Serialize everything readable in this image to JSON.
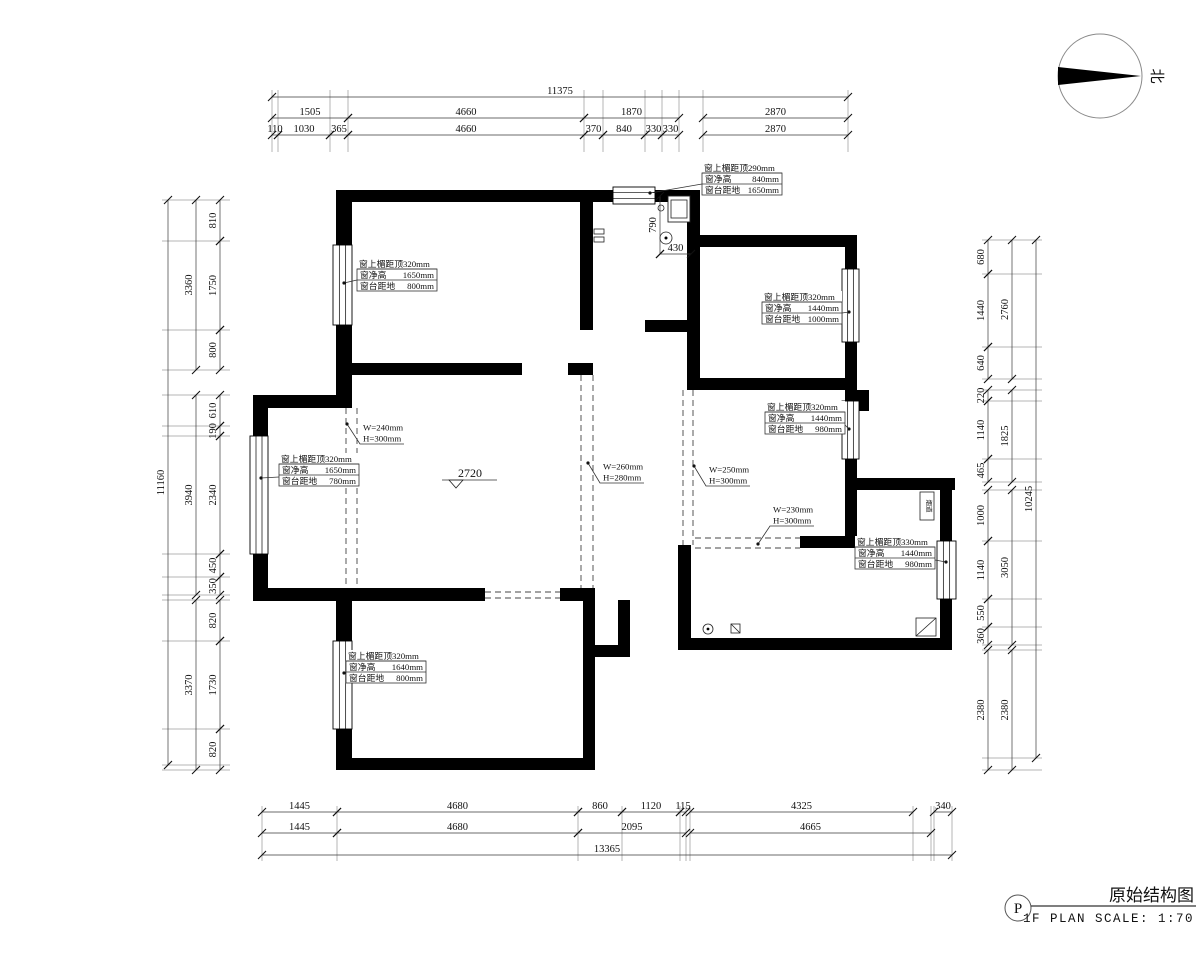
{
  "title_block": {
    "drawing_title": "原始结构图",
    "plan_label": "1F PLAN  SCALE: 1:70",
    "badge": "P"
  },
  "north_arrow": {
    "label": "北"
  },
  "level_mark": {
    "value": "2720"
  },
  "flue": {
    "label": "烟道"
  },
  "window_tags": [
    {
      "x": 702,
      "y": 162,
      "dot": [
        650,
        193
      ],
      "pts": [
        [
          650,
          193
        ],
        [
          702,
          184
        ]
      ],
      "l1": "窗上楣距顶290mm",
      "l2_label": "窗净高",
      "l2_val": "840mm",
      "l3_label": "窗台距地",
      "l3_val": "1650mm"
    },
    {
      "x": 357,
      "y": 258,
      "dot": [
        344,
        283
      ],
      "pts": [
        [
          344,
          283
        ],
        [
          357,
          280
        ]
      ],
      "l1": "窗上楣距顶320mm",
      "l2_label": "窗净高",
      "l2_val": "1650mm",
      "l3_label": "窗台距地",
      "l3_val": "800mm"
    },
    {
      "x": 762,
      "y": 291,
      "dot": [
        849,
        312
      ],
      "pts": [
        [
          849,
          312
        ],
        [
          842,
          313
        ]
      ],
      "l1": "窗上楣距顶320mm",
      "l2_label": "窗净高",
      "l2_val": "1440mm",
      "l3_label": "窗台距地",
      "l3_val": "1000mm"
    },
    {
      "x": 279,
      "y": 453,
      "dot": [
        261,
        478
      ],
      "pts": [
        [
          261,
          478
        ],
        [
          279,
          477
        ]
      ],
      "l1": "窗上楣距顶320mm",
      "l2_label": "窗净高",
      "l2_val": "1650mm",
      "l3_label": "窗台距地",
      "l3_val": "780mm"
    },
    {
      "x": 765,
      "y": 401,
      "dot": [
        849,
        429
      ],
      "pts": [
        [
          845,
          425
        ],
        [
          849,
          429
        ]
      ],
      "l1": "窗上楣距顶320mm",
      "l2_label": "窗净高",
      "l2_val": "1440mm",
      "l3_label": "窗台距地",
      "l3_val": "980mm"
    },
    {
      "x": 855,
      "y": 536,
      "dot": [
        946,
        562
      ],
      "pts": [
        [
          935,
          560
        ],
        [
          946,
          562
        ]
      ],
      "l1": "窗上楣距顶330mm",
      "l2_label": "窗净高",
      "l2_val": "1440mm",
      "l3_label": "窗台距地",
      "l3_val": "980mm"
    },
    {
      "x": 346,
      "y": 650,
      "dot": [
        344,
        673
      ],
      "pts": [
        [
          344,
          673
        ],
        [
          346,
          672
        ]
      ],
      "l1": "窗上楣距顶320mm",
      "l2_label": "窗净高",
      "l2_val": "1640mm",
      "l3_label": "窗台距地",
      "l3_val": "800mm"
    }
  ],
  "beam_tags": [
    {
      "dot": [
        347,
        424
      ],
      "elbow": [
        360,
        444
      ],
      "endx": 404,
      "lines": [
        "W=240mm",
        "H=300mm"
      ]
    },
    {
      "dot": [
        588,
        463
      ],
      "elbow": [
        600,
        483
      ],
      "endx": 644,
      "lines": [
        "W=260mm",
        "H=280mm"
      ]
    },
    {
      "dot": [
        694,
        466
      ],
      "elbow": [
        706,
        486
      ],
      "endx": 750,
      "lines": [
        "W=250mm",
        "H=300mm"
      ]
    },
    {
      "dot": [
        758,
        544
      ],
      "elbow": [
        770,
        526
      ],
      "endx": 814,
      "lines": [
        "W=230mm",
        "H=300mm"
      ]
    }
  ],
  "dim_rows": [
    {
      "name": "top-total",
      "orient": "h",
      "side": "top",
      "line": 97,
      "segs": [
        {
          "v": "11375",
          "a": 272,
          "b": 848
        }
      ]
    },
    {
      "name": "top-mid",
      "orient": "h",
      "side": "top",
      "line": 118,
      "segs": [
        {
          "v": "1505",
          "a": 272,
          "b": 348
        },
        {
          "v": "4660",
          "a": 348,
          "b": 584
        },
        {
          "v": "1870",
          "a": 584,
          "b": 679
        },
        {
          "v": "2870",
          "a": 703,
          "b": 848
        }
      ]
    },
    {
      "name": "top-detail",
      "orient": "h",
      "side": "top",
      "line": 135,
      "segs": [
        {
          "v": "110",
          "a": 272,
          "b": 278
        },
        {
          "v": "1030",
          "a": 278,
          "b": 330
        },
        {
          "v": "365",
          "a": 330,
          "b": 348
        },
        {
          "v": "4660",
          "a": 348,
          "b": 584
        },
        {
          "v": "370",
          "a": 584,
          "b": 603
        },
        {
          "v": "840",
          "a": 603,
          "b": 645
        },
        {
          "v": "330",
          "a": 645,
          "b": 662
        },
        {
          "v": "330",
          "a": 662,
          "b": 679
        },
        {
          "v": "2870",
          "a": 703,
          "b": 848
        }
      ]
    },
    {
      "name": "bottom-detail",
      "orient": "h",
      "side": "bottom",
      "line": 812,
      "segs": [
        {
          "v": "1445",
          "a": 262,
          "b": 337
        },
        {
          "v": "4680",
          "a": 337,
          "b": 578
        },
        {
          "v": "860",
          "a": 578,
          "b": 622
        },
        {
          "v": "1120",
          "a": 622,
          "b": 680
        },
        {
          "v": "115",
          "a": 680,
          "b": 686
        },
        {
          "v": "4325",
          "a": 690,
          "b": 913
        },
        {
          "v": "340",
          "a": 934,
          "b": 952
        }
      ]
    },
    {
      "name": "bottom-mid",
      "orient": "h",
      "side": "bottom",
      "line": 833,
      "segs": [
        {
          "v": "1445",
          "a": 262,
          "b": 337
        },
        {
          "v": "4680",
          "a": 337,
          "b": 578
        },
        {
          "v": "2095",
          "a": 578,
          "b": 686
        },
        {
          "v": "4665",
          "a": 690,
          "b": 931
        }
      ]
    },
    {
      "name": "bottom-total",
      "orient": "h",
      "side": "bottom",
      "line": 855,
      "segs": [
        {
          "v": "13365",
          "a": 262,
          "b": 952
        }
      ]
    },
    {
      "name": "left-total",
      "orient": "v",
      "side": "left",
      "line": 168,
      "segs": [
        {
          "v": "11160",
          "a": 200,
          "b": 765
        }
      ]
    },
    {
      "name": "left-mid",
      "orient": "v",
      "side": "left",
      "line": 196,
      "segs": [
        {
          "v": "3360",
          "a": 200,
          "b": 370
        },
        {
          "v": "3940",
          "a": 395,
          "b": 595
        },
        {
          "v": "3370",
          "a": 600,
          "b": 770
        }
      ]
    },
    {
      "name": "left-detail",
      "orient": "v",
      "side": "left",
      "line": 220,
      "segs": [
        {
          "v": "810",
          "a": 200,
          "b": 241
        },
        {
          "v": "1750",
          "a": 241,
          "b": 330
        },
        {
          "v": "800",
          "a": 330,
          "b": 370
        },
        {
          "v": "610",
          "a": 395,
          "b": 426
        },
        {
          "v": "190",
          "a": 426,
          "b": 436
        },
        {
          "v": "2340",
          "a": 436,
          "b": 554
        },
        {
          "v": "450",
          "a": 554,
          "b": 577
        },
        {
          "v": "350",
          "a": 577,
          "b": 595
        },
        {
          "v": "820",
          "a": 600,
          "b": 641
        },
        {
          "v": "1730",
          "a": 641,
          "b": 729
        },
        {
          "v": "820",
          "a": 729,
          "b": 770
        }
      ]
    },
    {
      "name": "right-detail",
      "orient": "v",
      "side": "right",
      "line": 988,
      "segs": [
        {
          "v": "680",
          "a": 240,
          "b": 274
        },
        {
          "v": "1440",
          "a": 274,
          "b": 347
        },
        {
          "v": "640",
          "a": 347,
          "b": 379
        },
        {
          "v": "220",
          "a": 390,
          "b": 401
        },
        {
          "v": "1140",
          "a": 401,
          "b": 459
        },
        {
          "v": "465",
          "a": 459,
          "b": 482
        },
        {
          "v": "1000",
          "a": 490,
          "b": 541
        },
        {
          "v": "1140",
          "a": 541,
          "b": 599
        },
        {
          "v": "550",
          "a": 599,
          "b": 627
        },
        {
          "v": "360",
          "a": 627,
          "b": 645
        },
        {
          "v": "2380",
          "a": 650,
          "b": 770
        }
      ]
    },
    {
      "name": "right-mid",
      "orient": "v",
      "side": "right",
      "line": 1012,
      "segs": [
        {
          "v": "2760",
          "a": 240,
          "b": 379
        },
        {
          "v": "1825",
          "a": 390,
          "b": 482
        },
        {
          "v": "3050",
          "a": 490,
          "b": 645
        },
        {
          "v": "2380",
          "a": 650,
          "b": 770
        }
      ]
    },
    {
      "name": "right-total",
      "orient": "v",
      "side": "right",
      "line": 1036,
      "segs": [
        {
          "v": "10245",
          "a": 240,
          "b": 758
        }
      ]
    },
    {
      "name": "bath-height",
      "orient": "v",
      "side": "none",
      "line": 660,
      "segs": [
        {
          "v": "790",
          "a": 196,
          "b": 254
        }
      ]
    },
    {
      "name": "bath-width",
      "orient": "h",
      "side": "none",
      "line": 254,
      "segs": [
        {
          "v": "430",
          "a": 660,
          "b": 691
        }
      ]
    }
  ]
}
